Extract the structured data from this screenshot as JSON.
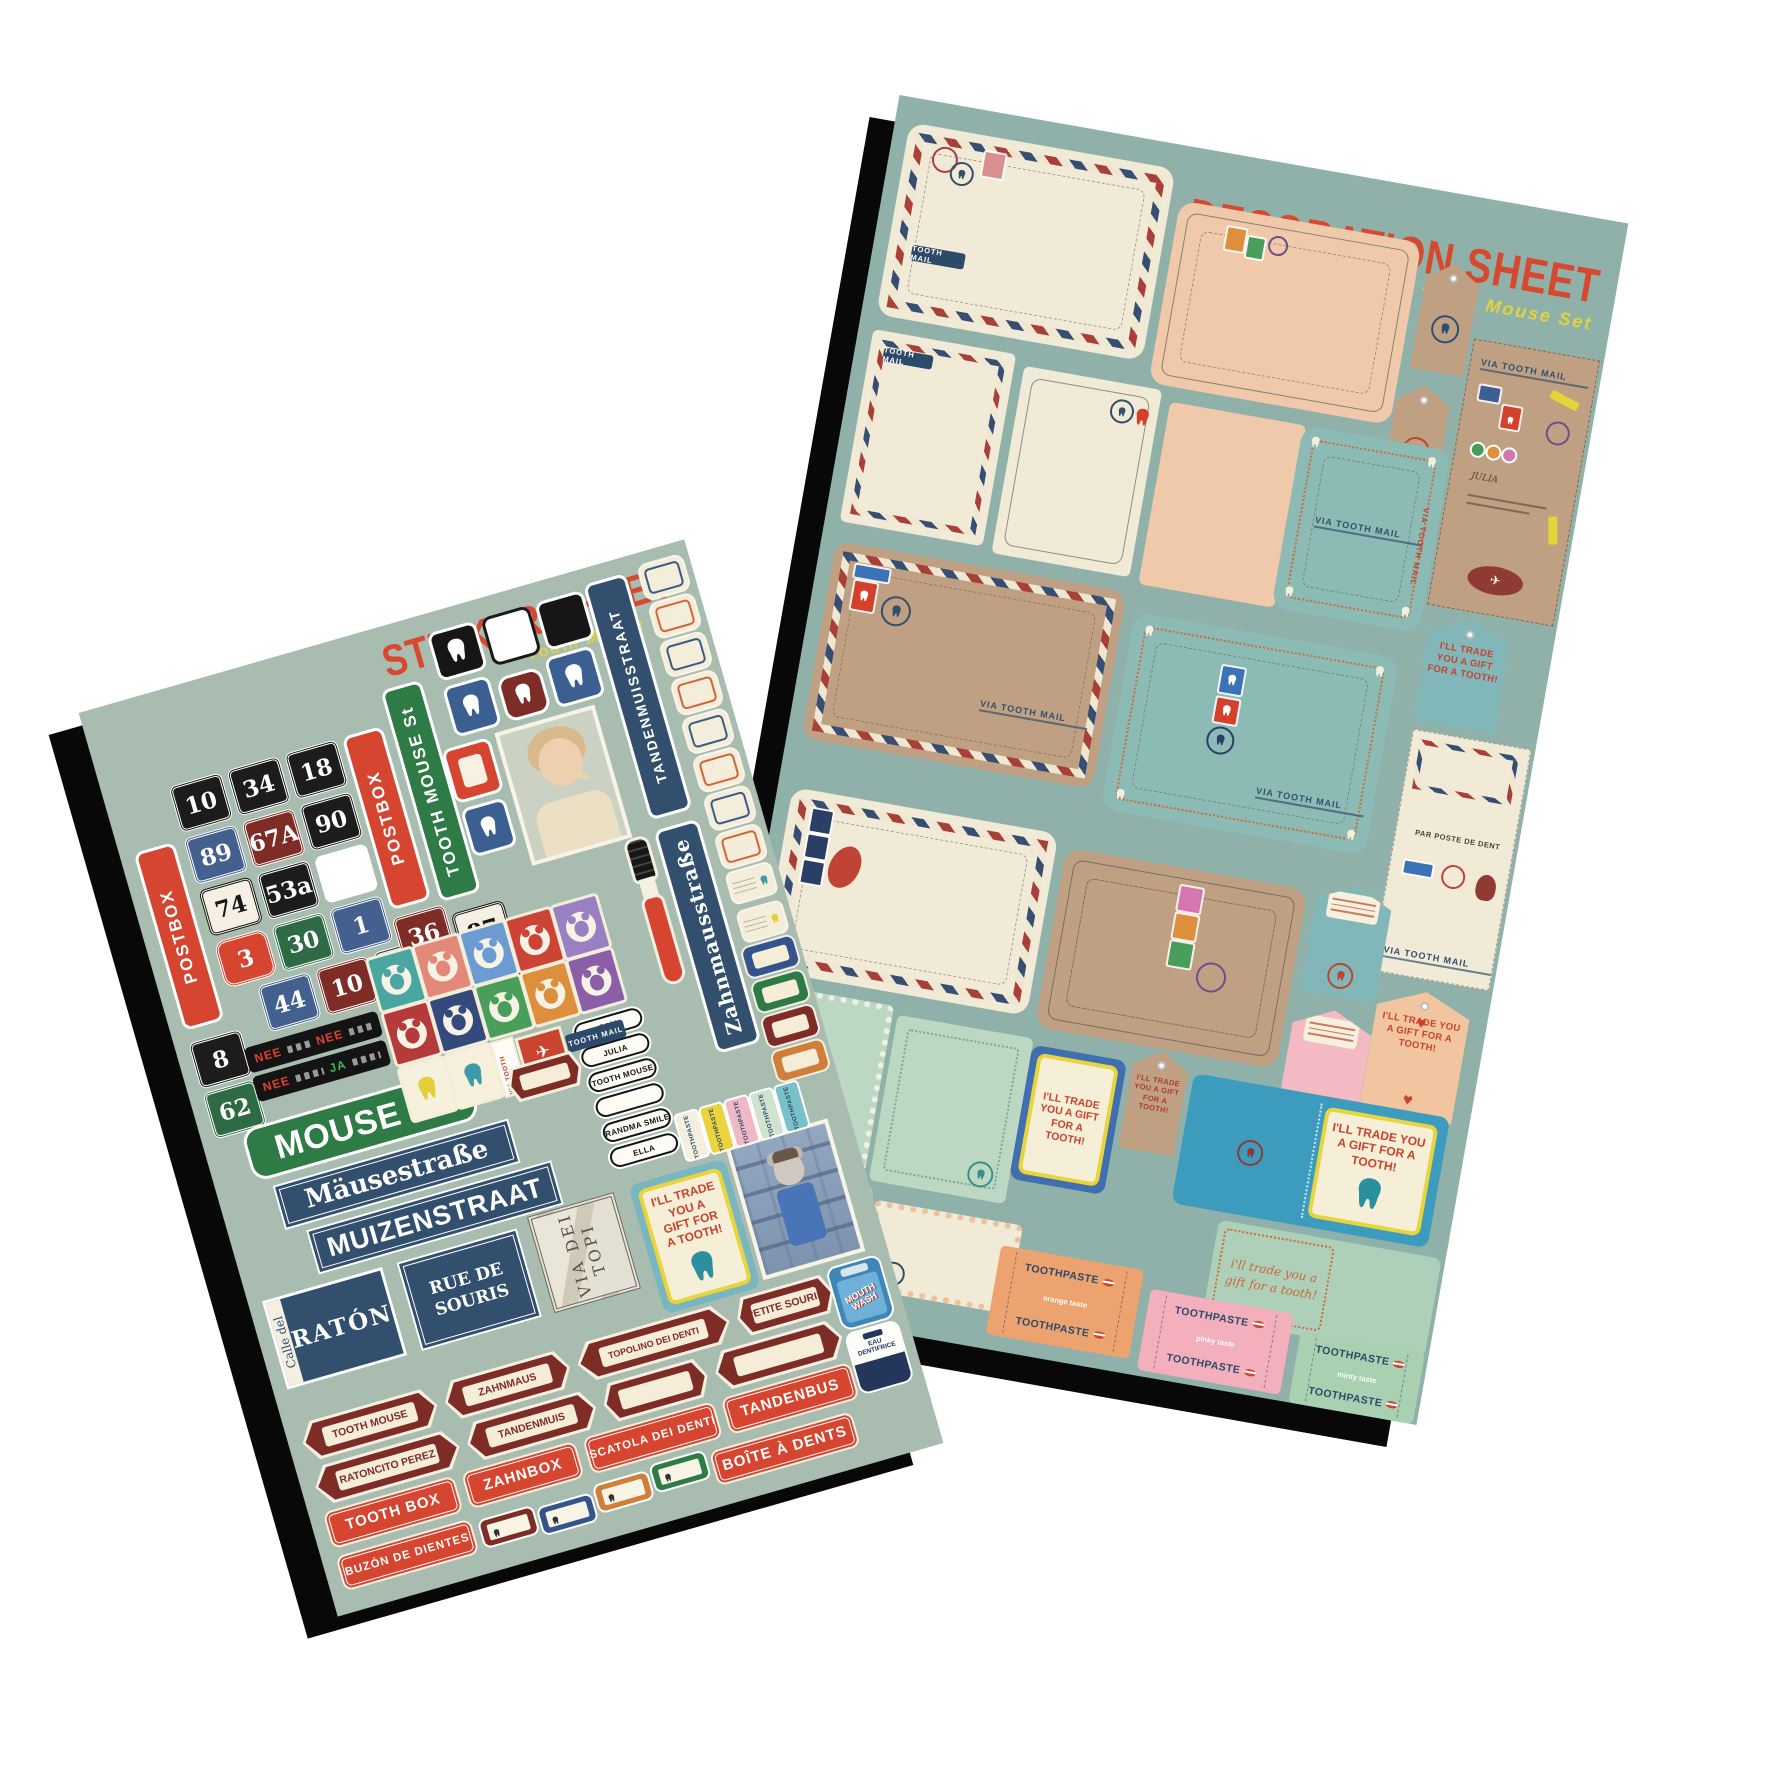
{
  "colors": {
    "canvas_background": "#ffffff",
    "sticker_sheet_background": "#a9bcb0",
    "decoration_sheet_background": "#90b1aa",
    "title_red": "#d7492f",
    "subtitle_yellow": "#e0d33c",
    "sign_red": "#d6452f",
    "sign_green": "#2e7b46",
    "sign_navy": "#32506e",
    "tag_maroon": "#7d2c26",
    "kraft": "#c0a083",
    "cream": "#f1ead6",
    "teal_envelope": "#8cbab5"
  },
  "sticker_sheet": {
    "title": "STICKER SHEET",
    "subtitle": "Tooth Mouse Set",
    "via_tooth_mail": "VIA TOOTH MAIL",
    "tooth_mail": "TOOTH MAIL",
    "house_numbers": [
      {
        "text": "10",
        "style": "black"
      },
      {
        "text": "34",
        "style": "black"
      },
      {
        "text": "18",
        "style": "black"
      },
      {
        "text": "89",
        "style": "blue"
      },
      {
        "text": "67A",
        "style": "maroon"
      },
      {
        "text": "90",
        "style": "black"
      },
      {
        "text": "74",
        "style": "white"
      },
      {
        "text": "53a",
        "style": "black"
      },
      {
        "text": "",
        "style": "blank"
      },
      {
        "text": "3",
        "style": "red"
      },
      {
        "text": "30",
        "style": "green"
      },
      {
        "text": "1",
        "style": "blue"
      },
      {
        "text": "44",
        "style": "blue"
      },
      {
        "text": "10",
        "style": "maroon"
      },
      {
        "text": "29",
        "style": "black"
      },
      {
        "text": "8",
        "style": "black"
      },
      {
        "text": "62",
        "style": "green"
      },
      {
        "text": "36",
        "style": "maroon"
      },
      {
        "text": "87",
        "style": "white"
      },
      {
        "text": "84",
        "style": "black"
      }
    ],
    "vertical_signs": [
      {
        "text": "POSTBOX",
        "style": "red"
      },
      {
        "text": "POSTBOX",
        "style": "red"
      },
      {
        "text": "TOOTH MOUSE St",
        "style": "green"
      },
      {
        "text": "TANDENMUISSTRAAT",
        "style": "navy"
      },
      {
        "text": "Zahnmausstraße",
        "style": "navy-serif"
      }
    ],
    "option_strips": [
      {
        "a": "NEE",
        "b": "NEE"
      },
      {
        "a": "NEE",
        "b": "JA"
      }
    ],
    "street_signs": [
      {
        "text": "MOUSE St"
      },
      {
        "text": "Mäusestraße"
      },
      {
        "text": "MUIZENSTRAAT"
      },
      {
        "prefix": "Calle del",
        "text": "RATÓN"
      },
      {
        "text": "RUE DE SOURIS"
      },
      {
        "text": "VIA DEI TOPI"
      }
    ],
    "name_plates": [
      {
        "text": "SAM"
      },
      {
        "text": "JULIA"
      },
      {
        "text": "TOOTH MOUSE"
      },
      {
        "text": ""
      },
      {
        "text": "GRANDMA SMILES"
      },
      {
        "text": "ELLA"
      }
    ],
    "trade_card": {
      "text": "I'LL TRADE YOU A GIFT FOR A TOOTH!"
    },
    "oval_tags": [
      {
        "text": "TOOTH MOUSE"
      },
      {
        "text": "ZAHNMAUS"
      },
      {
        "text": "TOPOLINO DEI DENTI"
      },
      {
        "text": "PETITE SOURIS"
      },
      {
        "text": "RATONCITO PEREZ"
      },
      {
        "text": "TANDENMUIS"
      },
      {
        "text": ""
      },
      {
        "text": ""
      },
      {
        "text": ""
      }
    ],
    "red_labels": [
      {
        "text": "TOOTH BOX"
      },
      {
        "text": "ZAHNBOX"
      },
      {
        "text": "SCATOLA DEI DENTI"
      },
      {
        "text": "TANDENBUS"
      },
      {
        "text": "BUZÓN DE DIENTES"
      },
      {
        "text": "BOÎTE À DENTS"
      }
    ],
    "toothpaste_label": "TOOTHPASTE",
    "bottles": [
      {
        "text": "MOUTH WASH"
      },
      {
        "text": "EAU DENTIFRICE"
      }
    ]
  },
  "decoration_sheet": {
    "title": "DECORATION SHEET",
    "subtitle": "Tooth Mouse Set",
    "via_tooth_mail": "VIA TOOTH MAIL",
    "tooth_mail": "TOOTH MAIL",
    "par_poste": "PAR POSTE DE DENT",
    "address_name": "JULIA",
    "trade_tag_text": "I'LL TRADE YOU A GIFT FOR A TOOTH!",
    "trade_card_text": "I'LL TRADE YOU A GIFT FOR A TOOTH!",
    "trade_card_lower": "i'll trade you a gift for a tooth!",
    "toothpaste_boxes": [
      {
        "label": "TOOTHPASTE",
        "flavor": "orange taste",
        "color": "#eca36f"
      },
      {
        "label": "TOOTHPASTE",
        "flavor": "pinky taste",
        "color": "#f3afbc"
      },
      {
        "label": "TOOTHPASTE",
        "flavor": "minty taste",
        "color": "#a9d0b0"
      }
    ]
  }
}
